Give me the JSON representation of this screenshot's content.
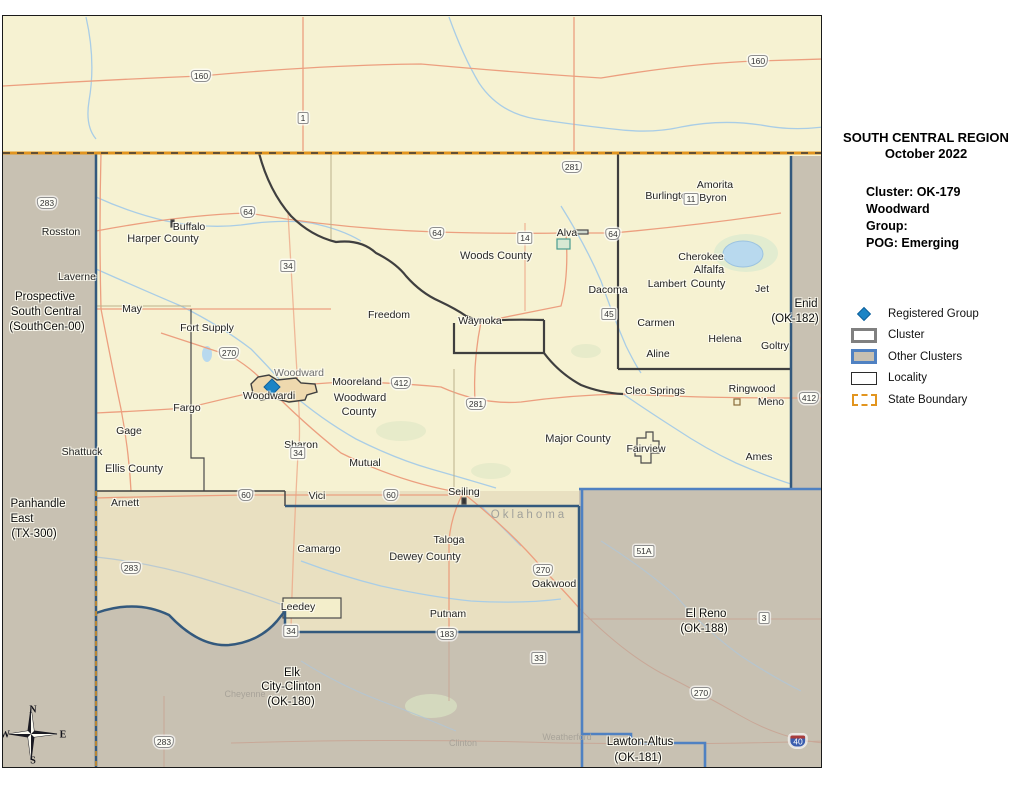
{
  "panel": {
    "title_line1": "SOUTH CENTRAL REGION",
    "title_line2": "October 2022",
    "cluster_lines": [
      "Cluster: OK-179",
      "Woodward",
      "Group:",
      "POG: Emerging"
    ],
    "legend": [
      {
        "key": "registered-group",
        "label": "Registered Group"
      },
      {
        "key": "cluster",
        "label": "Cluster"
      },
      {
        "key": "other-clusters",
        "label": "Other Clusters"
      },
      {
        "key": "locality",
        "label": "Locality"
      },
      {
        "key": "state-boundary",
        "label": "State Boundary"
      }
    ],
    "scale": {
      "unit": "Miles",
      "ticks": [
        "0",
        "11",
        "22"
      ]
    },
    "source_lines": [
      "Source:",
      "Baha'i National Center, IT Dept,",
      "GIS Desk",
      "mvargha@usbnc.org"
    ]
  },
  "colors": {
    "cluster_fill": "#f6f2d2",
    "other_cluster_fill": "#c8c1b2",
    "dewey_fill": "#e9e0c1",
    "state_boundary": "#e2951f",
    "other_cluster_border": "#4f81c2",
    "registered_group": "#1b84c6",
    "road": "#ec9f7f",
    "river": "#a9cde6"
  },
  "map": {
    "compass": [
      {
        "t": "N",
        "x": 32,
        "y": 709
      },
      {
        "t": "E",
        "x": 62,
        "y": 734
      },
      {
        "t": "S",
        "x": 32,
        "y": 760
      },
      {
        "t": "W",
        "x": 4,
        "y": 734
      }
    ],
    "labels": [
      {
        "t": "Rosston",
        "x": 60,
        "y": 231,
        "c": "town"
      },
      {
        "t": "Buffalo",
        "x": 188,
        "y": 226,
        "c": "town"
      },
      {
        "t": "Harper County",
        "x": 162,
        "y": 238,
        "c": "county"
      },
      {
        "t": "Laverne",
        "x": 76,
        "y": 276,
        "c": "town"
      },
      {
        "t": "May",
        "x": 131,
        "y": 308,
        "c": "town"
      },
      {
        "t": "Fort Supply",
        "x": 206,
        "y": 327,
        "c": "town"
      },
      {
        "t": "Freedom",
        "x": 388,
        "y": 314,
        "c": "town"
      },
      {
        "t": "Woods County",
        "x": 495,
        "y": 255,
        "c": "county"
      },
      {
        "t": "Alva",
        "x": 566,
        "y": 232,
        "c": "town"
      },
      {
        "t": "Burlington",
        "x": 668,
        "y": 195,
        "c": "town"
      },
      {
        "t": "Amorita",
        "x": 714,
        "y": 184,
        "c": "town"
      },
      {
        "t": "Byron",
        "x": 712,
        "y": 197,
        "c": "town"
      },
      {
        "t": "Cherokee",
        "x": 700,
        "y": 256,
        "c": "town"
      },
      {
        "t": "Alfalfa",
        "x": 708,
        "y": 269,
        "c": "county"
      },
      {
        "t": "County",
        "x": 707,
        "y": 283,
        "c": "county"
      },
      {
        "t": "Lambert",
        "x": 666,
        "y": 283,
        "c": "town"
      },
      {
        "t": "Dacoma",
        "x": 607,
        "y": 289,
        "c": "town"
      },
      {
        "t": "Jet",
        "x": 761,
        "y": 288,
        "c": "town"
      },
      {
        "t": "Carmen",
        "x": 655,
        "y": 322,
        "c": "town"
      },
      {
        "t": "Helena",
        "x": 724,
        "y": 338,
        "c": "town"
      },
      {
        "t": "Goltry",
        "x": 774,
        "y": 345,
        "c": "town"
      },
      {
        "t": "Aline",
        "x": 657,
        "y": 353,
        "c": "town"
      },
      {
        "t": "Waynoka",
        "x": 479,
        "y": 320,
        "c": "town"
      },
      {
        "t": "Woodward",
        "x": 298,
        "y": 372,
        "c": "cityname"
      },
      {
        "t": "Mooreland",
        "x": 356,
        "y": 381,
        "c": "town"
      },
      {
        "t": "Woodwardi",
        "x": 268,
        "y": 395,
        "c": "town"
      },
      {
        "t": "Woodward",
        "x": 359,
        "y": 397,
        "c": "county"
      },
      {
        "t": "County",
        "x": 358,
        "y": 411,
        "c": "county"
      },
      {
        "t": "Fargo",
        "x": 186,
        "y": 407,
        "c": "town"
      },
      {
        "t": "Gage",
        "x": 128,
        "y": 430,
        "c": "town"
      },
      {
        "t": "Shattuck",
        "x": 81,
        "y": 451,
        "c": "town"
      },
      {
        "t": "Ellis County",
        "x": 133,
        "y": 468,
        "c": "county"
      },
      {
        "t": "Sharon",
        "x": 300,
        "y": 444,
        "c": "town"
      },
      {
        "t": "Mutual",
        "x": 364,
        "y": 462,
        "c": "town"
      },
      {
        "t": "Arnett",
        "x": 124,
        "y": 502,
        "c": "town"
      },
      {
        "t": "Vici",
        "x": 316,
        "y": 495,
        "c": "town"
      },
      {
        "t": "Seiling",
        "x": 463,
        "y": 491,
        "c": "town"
      },
      {
        "t": "Cleo Springs",
        "x": 654,
        "y": 390,
        "c": "town"
      },
      {
        "t": "Ringwood",
        "x": 751,
        "y": 388,
        "c": "town"
      },
      {
        "t": "Meno",
        "x": 770,
        "y": 401,
        "c": "town"
      },
      {
        "t": "Ames",
        "x": 758,
        "y": 456,
        "c": "town"
      },
      {
        "t": "Major County",
        "x": 577,
        "y": 438,
        "c": "county"
      },
      {
        "t": "Fairview",
        "x": 645,
        "y": 448,
        "c": "town"
      },
      {
        "t": "Oklahoma",
        "x": 528,
        "y": 514,
        "c": "state"
      },
      {
        "t": "Camargo",
        "x": 318,
        "y": 548,
        "c": "town"
      },
      {
        "t": "Taloga",
        "x": 448,
        "y": 539,
        "c": "town"
      },
      {
        "t": "Dewey County",
        "x": 424,
        "y": 556,
        "c": "county"
      },
      {
        "t": "Oakwood",
        "x": 553,
        "y": 583,
        "c": "town"
      },
      {
        "t": "Leedey",
        "x": 297,
        "y": 606,
        "c": "town"
      },
      {
        "t": "Putnam",
        "x": 447,
        "y": 613,
        "c": "town"
      },
      {
        "t": "Prospective",
        "x": 44,
        "y": 296,
        "c": "cluster"
      },
      {
        "t": "South Central",
        "x": 45,
        "y": 311,
        "c": "cluster"
      },
      {
        "t": "(SouthCen-00)",
        "x": 46,
        "y": 326,
        "c": "cluster"
      },
      {
        "t": "Enid",
        "x": 805,
        "y": 303,
        "c": "cluster"
      },
      {
        "t": "(OK-182)",
        "x": 794,
        "y": 318,
        "c": "cluster"
      },
      {
        "t": "Panhandle",
        "x": 37,
        "y": 503,
        "c": "cluster"
      },
      {
        "t": "East",
        "x": 21,
        "y": 518,
        "c": "cluster"
      },
      {
        "t": "(TX-300)",
        "x": 33,
        "y": 533,
        "c": "cluster"
      },
      {
        "t": "El Reno",
        "x": 705,
        "y": 613,
        "c": "cluster"
      },
      {
        "t": "(OK-188)",
        "x": 703,
        "y": 628,
        "c": "cluster"
      },
      {
        "t": "Elk",
        "x": 291,
        "y": 672,
        "c": "cluster"
      },
      {
        "t": "City-Clinton",
        "x": 290,
        "y": 686,
        "c": "cluster"
      },
      {
        "t": "(OK-180)",
        "x": 290,
        "y": 701,
        "c": "cluster"
      },
      {
        "t": "Lawton-Altus",
        "x": 639,
        "y": 741,
        "c": "cluster"
      },
      {
        "t": "(OK-181)",
        "x": 637,
        "y": 757,
        "c": "cluster"
      },
      {
        "t": "Cheyenne",
        "x": 244,
        "y": 693,
        "c": "faint"
      },
      {
        "t": "Clinton",
        "x": 462,
        "y": 742,
        "c": "faint"
      },
      {
        "t": "Weatherford",
        "x": 566,
        "y": 736,
        "c": "faint"
      }
    ],
    "shields": [
      {
        "t": "160",
        "x": 200,
        "y": 75,
        "k": "us"
      },
      {
        "t": "160",
        "x": 757,
        "y": 60,
        "k": "us"
      },
      {
        "t": "1",
        "x": 302,
        "y": 117,
        "k": "st"
      },
      {
        "t": "281",
        "x": 571,
        "y": 166,
        "k": "us"
      },
      {
        "t": "283",
        "x": 46,
        "y": 202,
        "k": "us"
      },
      {
        "t": "64",
        "x": 247,
        "y": 211,
        "k": "us"
      },
      {
        "t": "64",
        "x": 436,
        "y": 232,
        "k": "us"
      },
      {
        "t": "64",
        "x": 612,
        "y": 233,
        "k": "us"
      },
      {
        "t": "14",
        "x": 524,
        "y": 237,
        "k": "st"
      },
      {
        "t": "11",
        "x": 690,
        "y": 198,
        "k": "st"
      },
      {
        "t": "34",
        "x": 287,
        "y": 265,
        "k": "st"
      },
      {
        "t": "45",
        "x": 608,
        "y": 313,
        "k": "st"
      },
      {
        "t": "270",
        "x": 228,
        "y": 352,
        "k": "us"
      },
      {
        "t": "412",
        "x": 400,
        "y": 382,
        "k": "us"
      },
      {
        "t": "281",
        "x": 475,
        "y": 403,
        "k": "us"
      },
      {
        "t": "412",
        "x": 808,
        "y": 397,
        "k": "us"
      },
      {
        "t": "34",
        "x": 297,
        "y": 452,
        "k": "st"
      },
      {
        "t": "60",
        "x": 245,
        "y": 494,
        "k": "us"
      },
      {
        "t": "60",
        "x": 390,
        "y": 494,
        "k": "us"
      },
      {
        "t": "283",
        "x": 130,
        "y": 567,
        "k": "us"
      },
      {
        "t": "270",
        "x": 542,
        "y": 569,
        "k": "us"
      },
      {
        "t": "51A",
        "x": 643,
        "y": 550,
        "k": "st"
      },
      {
        "t": "34",
        "x": 290,
        "y": 630,
        "k": "st"
      },
      {
        "t": "183",
        "x": 446,
        "y": 633,
        "k": "us"
      },
      {
        "t": "3",
        "x": 763,
        "y": 617,
        "k": "st"
      },
      {
        "t": "33",
        "x": 538,
        "y": 657,
        "k": "st"
      },
      {
        "t": "270",
        "x": 700,
        "y": 692,
        "k": "us"
      },
      {
        "t": "283",
        "x": 163,
        "y": 741,
        "k": "us"
      },
      {
        "t": "40",
        "x": 797,
        "y": 740,
        "k": "i"
      }
    ]
  }
}
